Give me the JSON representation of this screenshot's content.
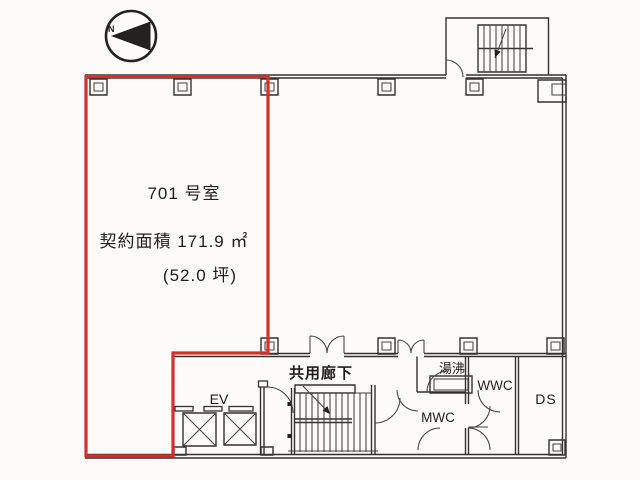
{
  "plan": {
    "compass": {
      "north_label": "N"
    },
    "room": {
      "name": "701 号室",
      "contract_area": "契約面積 171.9 ㎡",
      "area_tsubo": "(52.0 坪)"
    },
    "labels": {
      "elevator": "EV",
      "corridor": "共用廊下",
      "hot_water": "湯沸",
      "wwc": "WWC",
      "mwc": "MWC",
      "ds": "DS"
    },
    "colors": {
      "room_outline_red": "#d1312a",
      "line": "#34322e",
      "background": "#fcfbf9"
    }
  }
}
